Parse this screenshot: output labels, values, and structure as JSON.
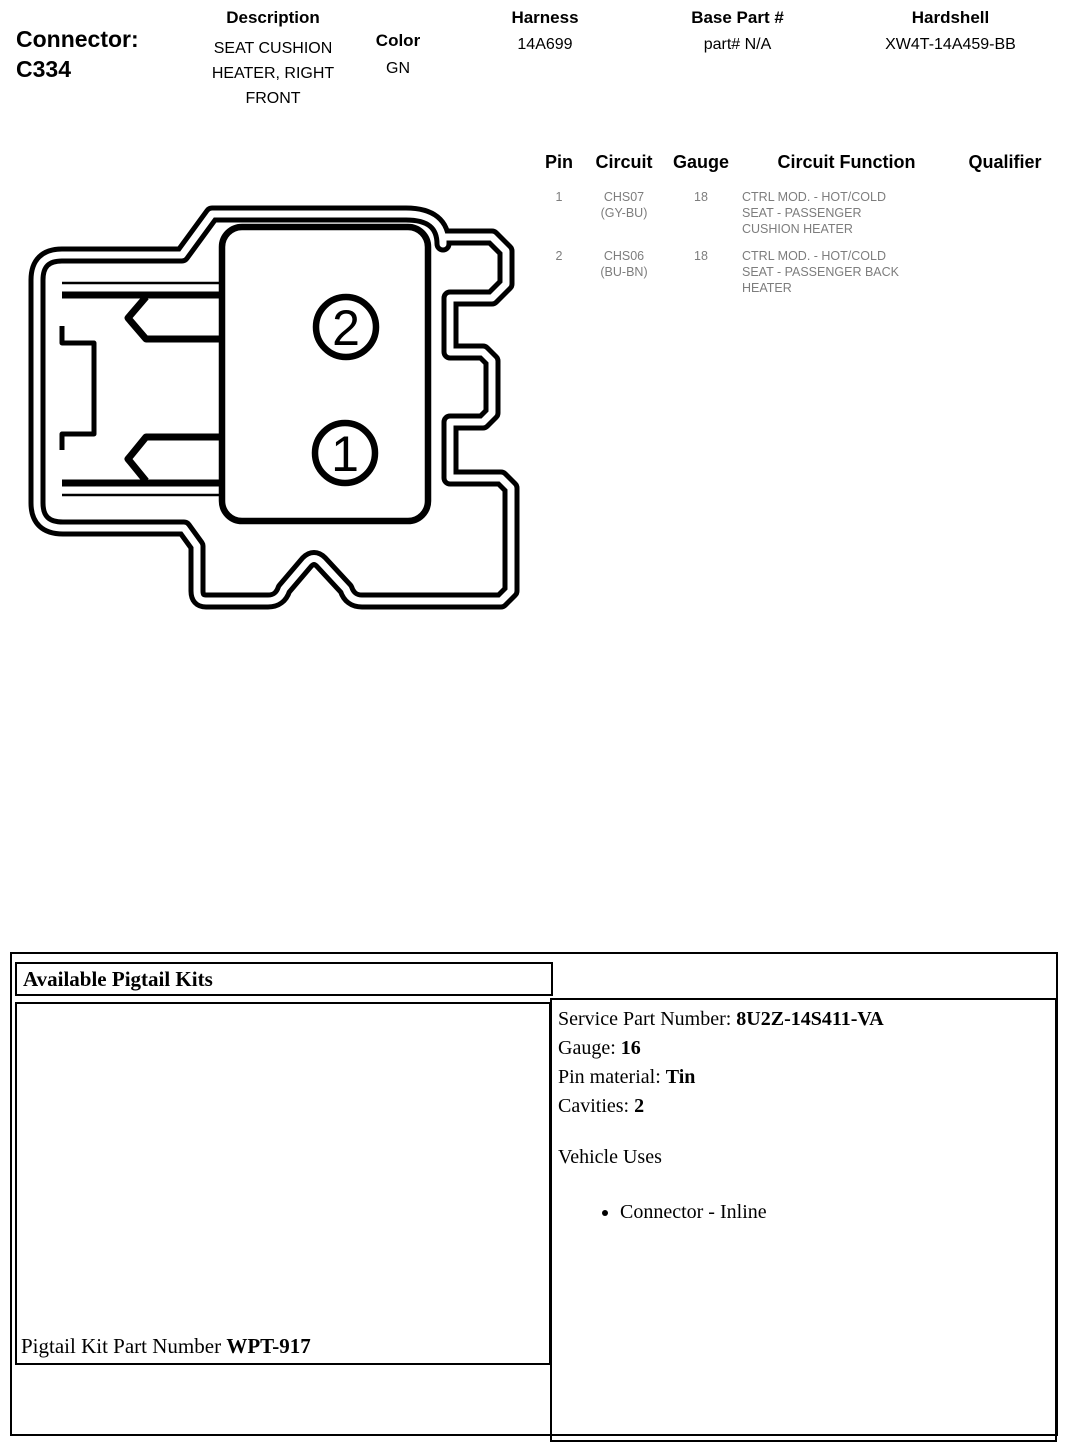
{
  "header": {
    "connector_label": "Connector:",
    "connector_id": "C334",
    "description_label": "Description",
    "description_value": "SEAT CUSHION\nHEATER, RIGHT\nFRONT",
    "color_label": "Color",
    "color_value": "GN",
    "harness_label": "Harness",
    "harness_value": "14A699",
    "base_part_label": "Base Part #",
    "base_part_value": "part# N/A",
    "hardshell_label": "Hardshell",
    "hardshell_value": "XW4T-14A459-BB"
  },
  "pin_table": {
    "headers": {
      "pin": "Pin",
      "circuit": "Circuit",
      "gauge": "Gauge",
      "function": "Circuit Function",
      "qualifier": "Qualifier"
    },
    "rows": [
      {
        "pin": "1",
        "circuit": "CHS07\n(GY-BU)",
        "gauge": "18",
        "function": "CTRL MOD. - HOT/COLD\nSEAT - PASSENGER\nCUSHION HEATER",
        "qualifier": ""
      },
      {
        "pin": "2",
        "circuit": "CHS06\n(BU-BN)",
        "gauge": "18",
        "function": "CTRL MOD. - HOT/COLD\nSEAT - PASSENGER BACK\nHEATER",
        "qualifier": ""
      }
    ]
  },
  "diagram": {
    "cavity_labels": [
      "2",
      "1"
    ]
  },
  "pigtail": {
    "title": "Available Pigtail Kits",
    "kit_label": "Pigtail Kit Part Number ",
    "kit_value": "WPT-917",
    "service_part_label": "Service Part Number: ",
    "service_part_value": "8U2Z-14S411-VA",
    "gauge_label": "Gauge: ",
    "gauge_value": "16",
    "pin_material_label": "Pin material: ",
    "pin_material_value": "Tin",
    "cavities_label": "Cavities: ",
    "cavities_value": "2",
    "vehicle_uses_label": "Vehicle Uses",
    "vehicle_uses": [
      "Connector - Inline"
    ]
  },
  "colors": {
    "line": "#000000",
    "table_body_text": "#7d7d7d",
    "background": "#ffffff"
  }
}
